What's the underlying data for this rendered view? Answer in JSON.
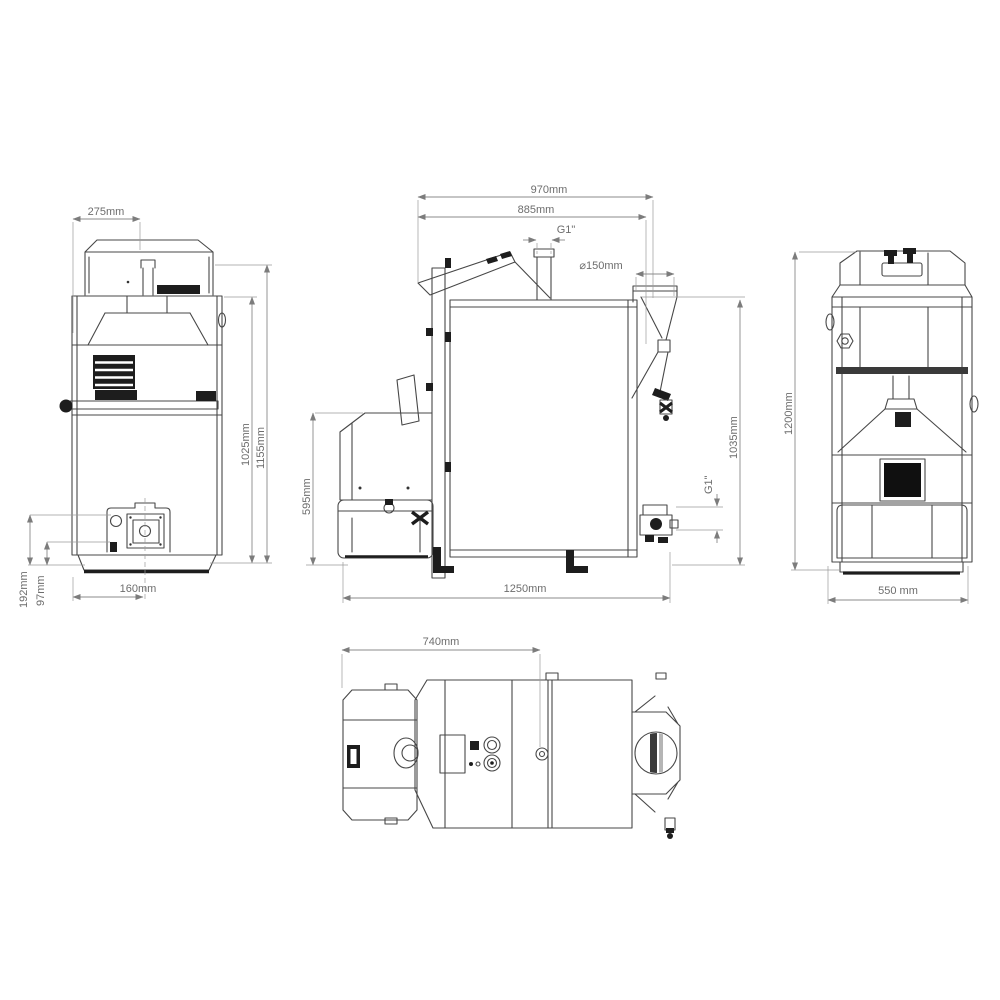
{
  "drawing": {
    "type": "technical-orthographic-views-pellet-boiler",
    "background": "#ffffff",
    "line_color": "#474747",
    "dimension_color": "#8b8b8b",
    "views": {
      "front": {
        "dims": {
          "hopper_width": "275mm",
          "body_height": "1025mm",
          "total_height": "1155mm",
          "burner_axis_height": "192mm",
          "drain_height": "97mm",
          "burner_offset": "160mm"
        }
      },
      "side": {
        "dims": {
          "total_depth": "970mm",
          "body_depth": "885mm",
          "top_fitting": "G1\"",
          "flue_diameter": "⌀150mm",
          "burner_height": "595mm",
          "flue_axis_height": "1035mm",
          "return_fitting": "G1\"",
          "total_length": "1250mm"
        }
      },
      "rear": {
        "dims": {
          "total_height": "1200mm",
          "total_width": "550 mm"
        }
      },
      "top": {
        "dims": {
          "front_width": "740mm"
        }
      }
    }
  }
}
